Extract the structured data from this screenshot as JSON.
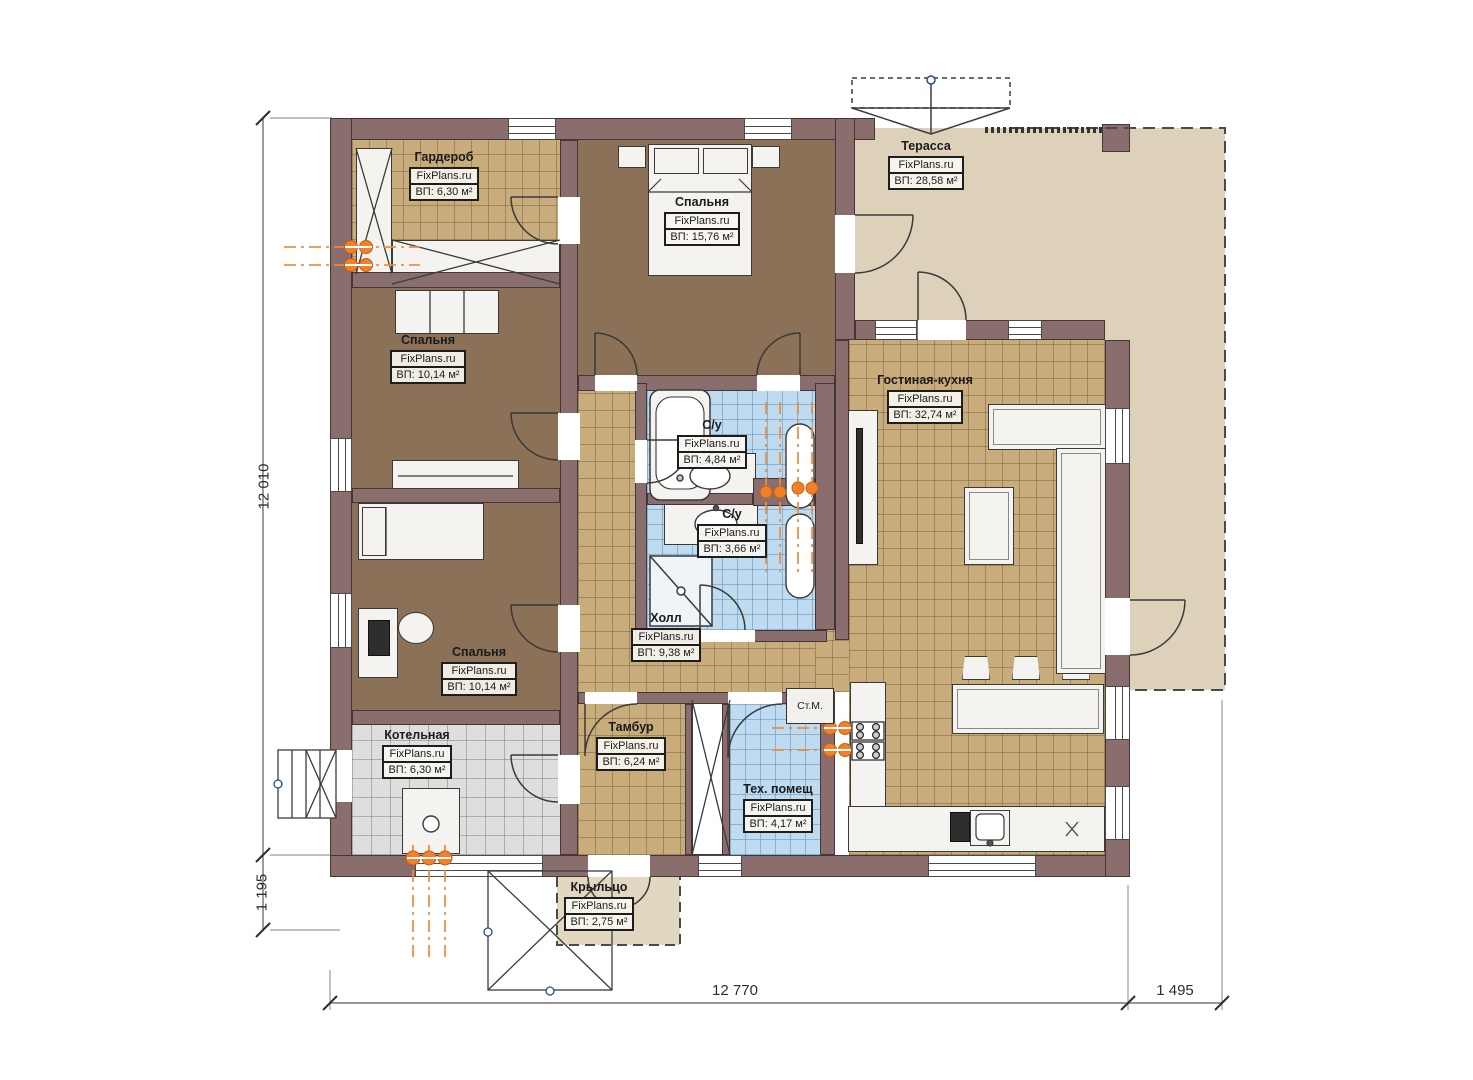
{
  "brand": "FixPlans.ru",
  "rooms": [
    {
      "id": "wardrobe",
      "name": "Гардероб",
      "brand": "FixPlans.ru",
      "area": "ВП: 6,30 м²"
    },
    {
      "id": "bedroom-master",
      "name": "Спальня",
      "brand": "FixPlans.ru",
      "area": "ВП: 15,76 м²"
    },
    {
      "id": "terrace",
      "name": "Терасса",
      "brand": "FixPlans.ru",
      "area": "ВП: 28,58 м²"
    },
    {
      "id": "bedroom-2",
      "name": "Спальня",
      "brand": "FixPlans.ru",
      "area": "ВП: 10,14 м²"
    },
    {
      "id": "living-kitchen",
      "name": "Гостиная-кухня",
      "brand": "FixPlans.ru",
      "area": "ВП: 32,74 м²"
    },
    {
      "id": "bathroom-1",
      "name": "С/у",
      "brand": "FixPlans.ru",
      "area": "ВП: 4,84 м²"
    },
    {
      "id": "bathroom-2",
      "name": "С/у",
      "brand": "FixPlans.ru",
      "area": "ВП: 3,66 м²"
    },
    {
      "id": "hall",
      "name": "Холл",
      "brand": "FixPlans.ru",
      "area": "ВП: 9,38 м²"
    },
    {
      "id": "bedroom-3",
      "name": "Спальня",
      "brand": "FixPlans.ru",
      "area": "ВП: 10,14 м²"
    },
    {
      "id": "boiler-room",
      "name": "Котельная",
      "brand": "FixPlans.ru",
      "area": "ВП: 6,30 м²"
    },
    {
      "id": "vestibule",
      "name": "Тамбур",
      "brand": "FixPlans.ru",
      "area": "ВП: 6,24 м²"
    },
    {
      "id": "tech-room",
      "name": "Тех. помещ",
      "brand": "FixPlans.ru",
      "area": "ВП: 4,17 м²"
    },
    {
      "id": "porch",
      "name": "Крыльцо",
      "brand": "FixPlans.ru",
      "area": "ВП: 2,75 м²"
    }
  ],
  "annotations": {
    "washing_machine": "Ст.М.",
    "fridge_mark": "x"
  },
  "dimensions": {
    "left_main": "12 010",
    "left_porch": "1 195",
    "bottom_main": "12 770",
    "bottom_right": "1 495"
  },
  "colors": {
    "wall": "#8a6e6e",
    "bedroom_floor": "#8a7158",
    "tile_floor": "#c9ac7c",
    "bath_floor": "#bedbf0",
    "boiler_floor": "#dedede",
    "terrace_floor": "#ddd1ba",
    "accent_orange": "#f08a3c"
  }
}
